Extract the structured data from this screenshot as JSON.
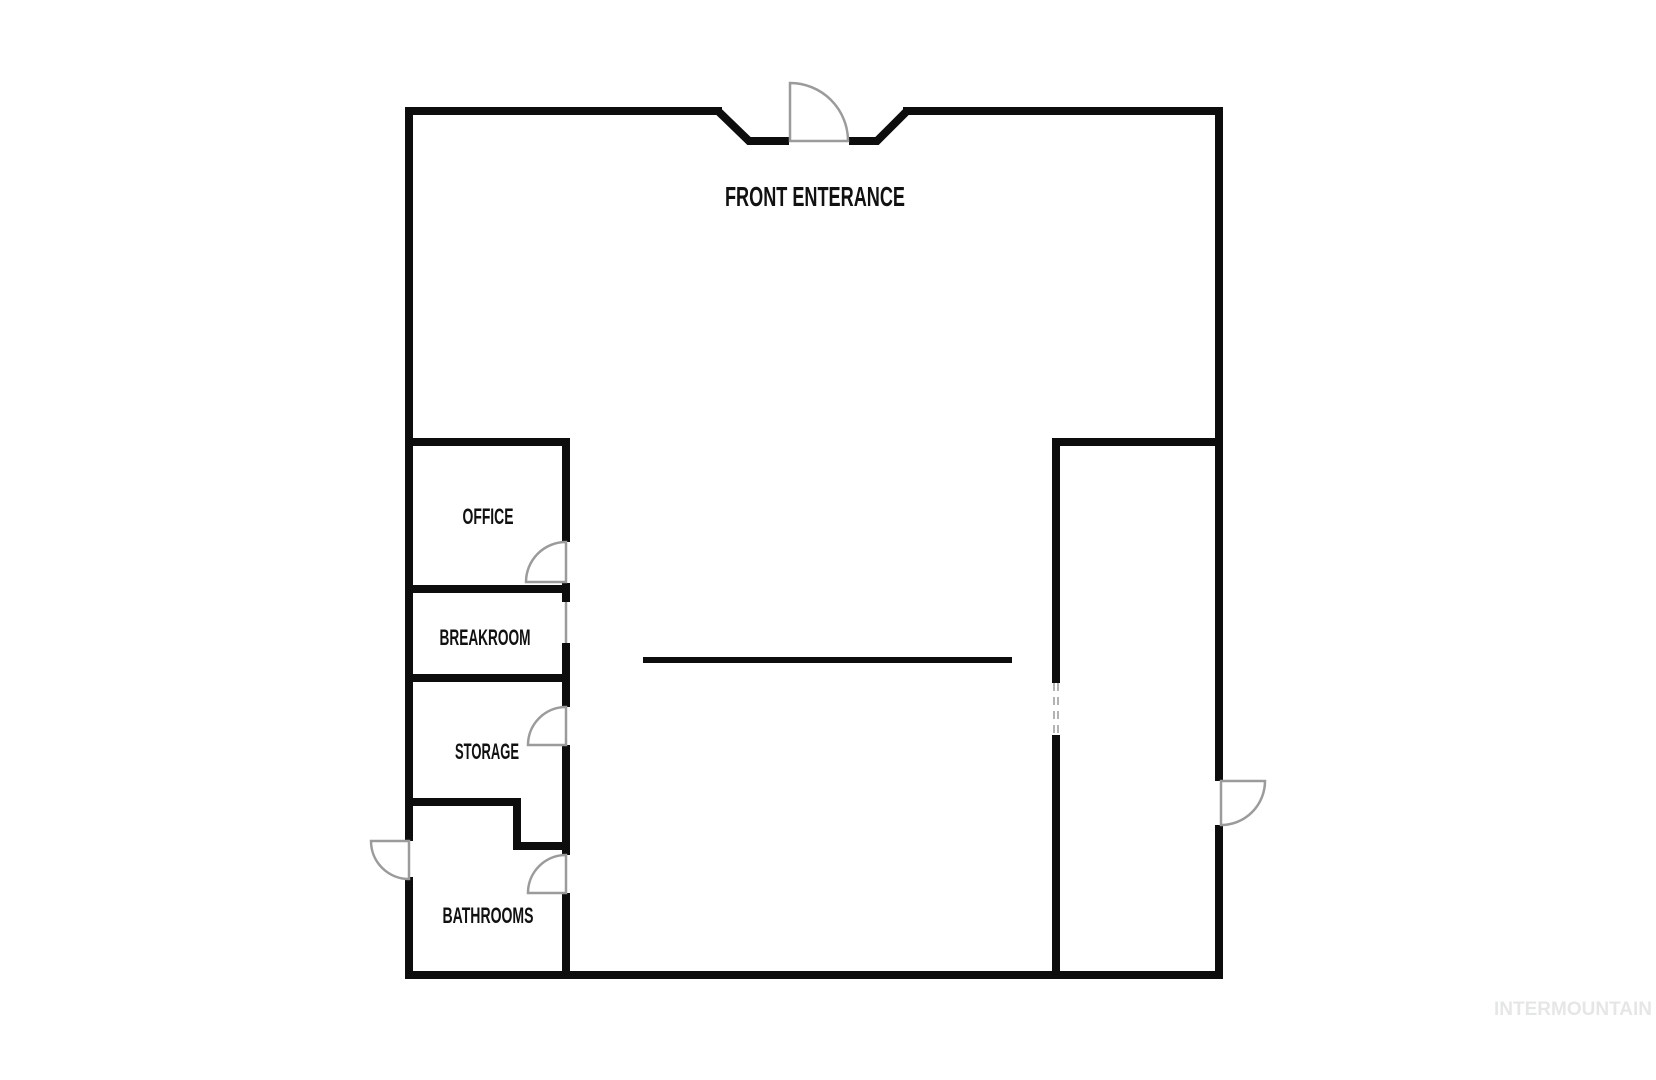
{
  "colors": {
    "wall": "#0d0d0d",
    "door_symbol": "#9b9b9b",
    "dashed_opening": "#b3b3b3",
    "room_label": "#111111",
    "watermark": "#e5e7e7",
    "background": "#ffffff"
  },
  "floorplan": {
    "entrance_label": "FRONT ENTERANCE",
    "rooms": [
      {
        "id": "office",
        "label": "OFFICE"
      },
      {
        "id": "breakroom",
        "label": "BREAKROOM"
      },
      {
        "id": "storage",
        "label": "STORAGE"
      },
      {
        "id": "bathrooms",
        "label": "BATHROOMS"
      }
    ]
  },
  "watermark": {
    "text": "INTERMOUNTAIN"
  }
}
